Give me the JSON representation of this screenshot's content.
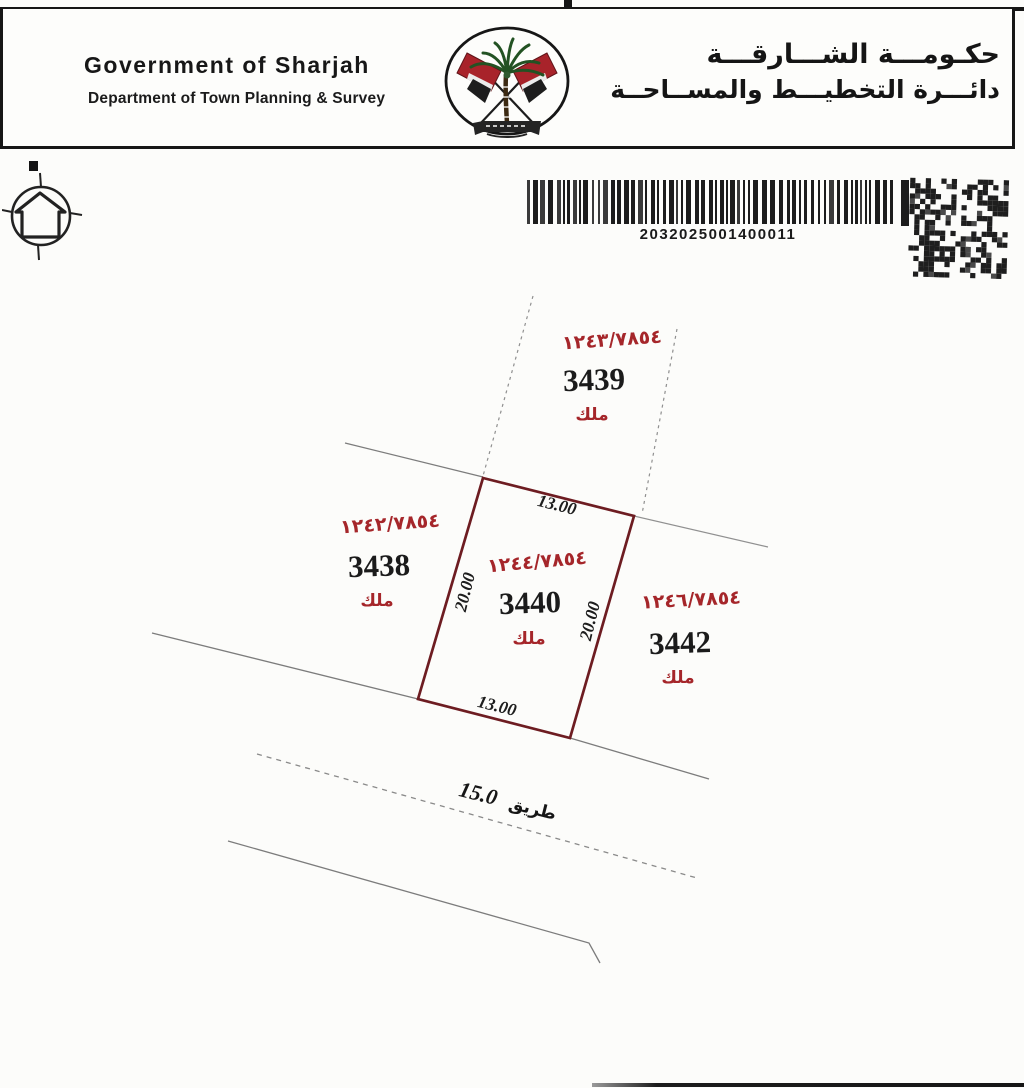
{
  "document": {
    "header": {
      "title_en": "Government of Sharjah",
      "subtitle_en": "Department of Town Planning & Survey",
      "title_ar": "حكـومـــة الشـــارقـــة",
      "subtitle_ar": "دائـــرة التخطيـــط والمســاحــة"
    },
    "barcode_number": "2032025001400011"
  },
  "map": {
    "plots": {
      "central": {
        "ref": "١٢٤٤/٧٨٥٤",
        "number": "3440",
        "owner": "ملك",
        "dim_top": "13.00",
        "dim_bottom": "13.00",
        "dim_left": "20.00",
        "dim_right": "20.00"
      },
      "north": {
        "ref": "١٢٤٣/٧٨٥٤",
        "number": "3439",
        "owner": "ملك"
      },
      "west": {
        "ref": "١٢٤٢/٧٨٥٤",
        "number": "3438",
        "owner": "ملك"
      },
      "east": {
        "ref": "١٢٤٦/٧٨٥٤",
        "number": "3442",
        "owner": "ملك"
      }
    },
    "road": {
      "name": "طريق",
      "width": "15.0"
    }
  },
  "colors": {
    "plot_border": "#6d1c21",
    "ref_text": "#a5262a",
    "number_text": "#1b1b1b",
    "boundary_line": "#7c7c7c"
  }
}
